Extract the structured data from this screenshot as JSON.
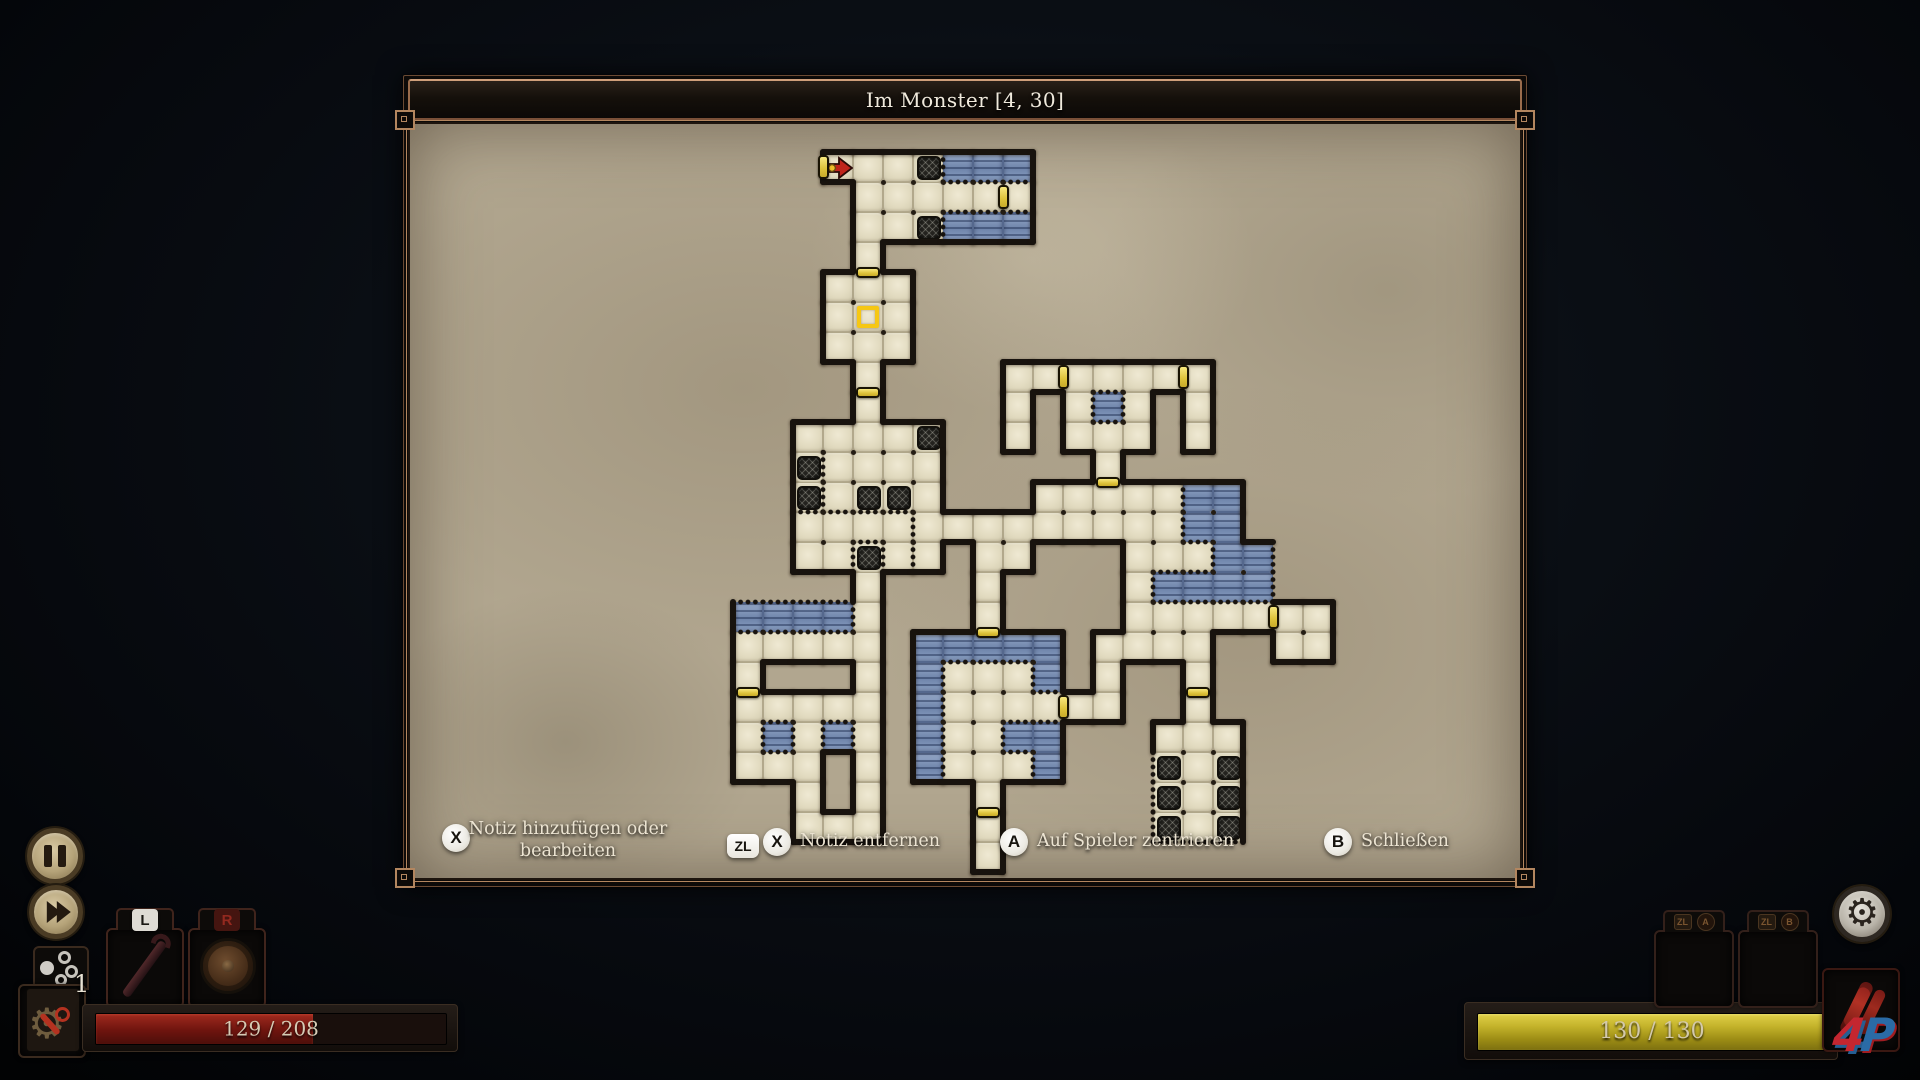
{
  "window": {
    "title": "Im Monster [4, 30]"
  },
  "prompts": {
    "add_note": {
      "button": "X",
      "label": "Notiz hinzufügen oder bearbeiten"
    },
    "remove_note": {
      "mod": "ZL",
      "button": "X",
      "label": "Notiz entfernen"
    },
    "center_player": {
      "button": "A",
      "label": "Auf Spieler zentrieren"
    },
    "close": {
      "button": "B",
      "label": "Schließen"
    }
  },
  "hud": {
    "health_bar": {
      "text": "129 / 208",
      "value": 129,
      "max": 208,
      "fill_pct": 62,
      "fill_color": "#8c1d16"
    },
    "energy_bar": {
      "text": "130 / 130",
      "value": 130,
      "max": 130,
      "fill_pct": 100,
      "fill_color": "#b3a41c"
    },
    "gadget_count": "1",
    "left_slot_key": "L",
    "right_slot_key": "R",
    "right_slot1_keys": [
      "ZL",
      "A"
    ],
    "right_slot2_keys": [
      "ZL",
      "B"
    ],
    "icons": {
      "gear": "⚙"
    },
    "logo_text_4": "4",
    "logo_text_p": "P"
  },
  "map": {
    "tile_size": 30,
    "origin_x": 732,
    "origin_y": 151,
    "cols": 21,
    "rows": 24,
    "colors": {
      "parchment": "#b1a68f",
      "floor": "#e6dfc6",
      "water": "#7f93b6",
      "wall": "#18130e",
      "door": "#e8cf4a",
      "player": "#f6c713",
      "arrow": "#bf241b"
    },
    "legend": {
      "F": "floor",
      "W": "water",
      "H": "hatched-tile",
      "A": "entrance-arrow",
      "P": "player-note-marker",
      ".": "empty"
    },
    "cells": [
      "...AFFHWWW...........",
      "....FFFFFF...........",
      "....FFHWWW...........",
      "....F................",
      "...FFF...............",
      "...FPF...............",
      "...FFF...............",
      "....F....FFFFFFF.....",
      "....F....F.FWF.F.....",
      "..FFFFH..F.FFF.F.....",
      "..HFFFF.....F........",
      "..HFHHF...FFFFFWW....",
      "..FFFFFFFFFFFFFWW....",
      "..FFHFF.FF...FFFWW...",
      "....F...F....FWWWW...",
      "WWWWF...F....FFFFFFF.",
      "FFFFF.WWWWW.FFFF..FF.",
      "F...F.WFFFW.F..F.....",
      "FFFFF.WFFFFFF..F.....",
      "FWFWF.WFFWW...FFF....",
      "FFF.F.WFFFW...HFH....",
      "..F.F...F.....HFH....",
      "..FFF...F.....HFH....",
      "........F............"
    ],
    "doors": [
      {
        "c": 3,
        "r": 0,
        "side": "left"
      },
      {
        "c": 9,
        "r": 1,
        "side": "left"
      },
      {
        "c": 4,
        "r": 4,
        "side": "top"
      },
      {
        "c": 4,
        "r": 8,
        "side": "top"
      },
      {
        "c": 11,
        "r": 7,
        "side": "left"
      },
      {
        "c": 15,
        "r": 7,
        "side": "left"
      },
      {
        "c": 12,
        "r": 11,
        "side": "top"
      },
      {
        "c": 8,
        "r": 16,
        "side": "top"
      },
      {
        "c": 11,
        "r": 18,
        "side": "left"
      },
      {
        "c": 18,
        "r": 15,
        "side": "left"
      },
      {
        "c": 15,
        "r": 18,
        "side": "top"
      },
      {
        "c": 8,
        "r": 22,
        "side": "top"
      },
      {
        "c": 0,
        "r": 18,
        "side": "top"
      }
    ],
    "dotted_edges": [
      [
        0,
        15,
        "top"
      ],
      [
        1,
        15,
        "top"
      ],
      [
        2,
        15,
        "top"
      ],
      [
        3,
        15,
        "top"
      ],
      [
        2,
        10,
        "right"
      ],
      [
        2,
        11,
        "right"
      ],
      [
        2,
        12,
        "top"
      ],
      [
        3,
        12,
        "top"
      ],
      [
        4,
        12,
        "top"
      ],
      [
        5,
        12,
        "top"
      ],
      [
        6,
        12,
        "left"
      ],
      [
        6,
        13,
        "left"
      ],
      [
        4,
        13,
        "left"
      ],
      [
        4,
        13,
        "top"
      ],
      [
        4,
        13,
        "right"
      ],
      [
        14,
        20,
        "left"
      ],
      [
        14,
        21,
        "left"
      ],
      [
        14,
        22,
        "left"
      ],
      [
        14,
        22,
        "bottom"
      ],
      [
        15,
        22,
        "bottom"
      ],
      [
        16,
        22,
        "bottom"
      ],
      [
        17,
        13,
        "right"
      ],
      [
        17,
        14,
        "right"
      ]
    ],
    "player_cell": {
      "c": 4,
      "r": 5
    },
    "entrance_cell": {
      "c": 3,
      "r": 0
    }
  }
}
